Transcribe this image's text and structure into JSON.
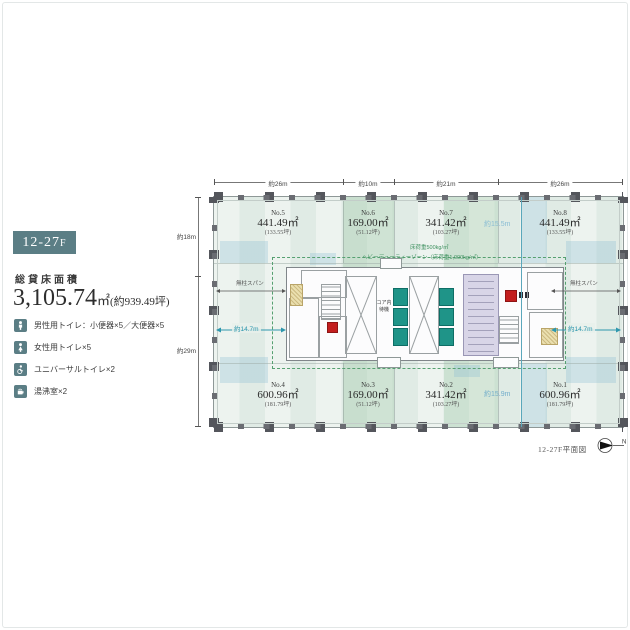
{
  "page": {
    "caption": "12-27F平面図",
    "north_label": "N"
  },
  "legend": {
    "floor_badge": "12-27",
    "floor_badge_suffix": "F",
    "area_label": "総貸床面積",
    "area_value": "3,105.74",
    "area_unit": "㎡",
    "area_tsubo": "(約939.49坪)",
    "facilities": [
      {
        "icon": "male-restroom-icon",
        "label": "男性用トイレ：小便器×5／大便器×5"
      },
      {
        "icon": "female-restroom-icon",
        "label": "女性用トイレ×5"
      },
      {
        "icon": "universal-restroom-icon",
        "label": "ユニバーサルトイレ×2"
      },
      {
        "icon": "kitchenette-icon",
        "label": "湯沸室×2"
      }
    ]
  },
  "plan": {
    "dims_top": [
      "約26m",
      "約10m",
      "約21m",
      "約26m"
    ],
    "dims_left": [
      "約18m",
      "約29m"
    ],
    "depth_top": "約15.5m",
    "depth_bottom": "約15.9m",
    "depth_left": "約14.7m",
    "depth_right": "約14.7m",
    "span_note_left": "無柱スパン",
    "span_note_right": "無柱スパン",
    "load_note_1": "床荷重500kg/㎡",
    "load_note_2": "ヘビーデューティーゾーン（床荷重1,000kg/㎡）",
    "core_label_line1": "コア内",
    "core_label_line2": "待機",
    "rooms_top": [
      {
        "no": "No.5",
        "area": "441.49㎡",
        "tsubo": "(133.55坪)"
      },
      {
        "no": "No.6",
        "area": "169.00㎡",
        "tsubo": "(51.12坪)"
      },
      {
        "no": "No.7",
        "area": "341.42㎡",
        "tsubo": "(103.27坪)"
      },
      {
        "no": "No.8",
        "area": "441.49㎡",
        "tsubo": "(133.55坪)"
      }
    ],
    "rooms_bottom": [
      {
        "no": "No.4",
        "area": "600.96㎡",
        "tsubo": "(181.79坪)"
      },
      {
        "no": "No.3",
        "area": "169.00㎡",
        "tsubo": "(51.12坪)"
      },
      {
        "no": "No.2",
        "area": "341.42㎡",
        "tsubo": "(103.27坪)"
      },
      {
        "no": "No.1",
        "area": "600.96㎡",
        "tsubo": "(181.79坪)"
      }
    ]
  },
  "colors": {
    "badge": "#5b7e85",
    "lease_bg": "#e8f0eb",
    "green_zone": "#a8ccad",
    "blue_zone": "#8cbed4",
    "elevator_teal": "#1f9488",
    "toilet_lavender": "#d8d5e7",
    "alarm_red": "#c31e1e",
    "note_green": "#3f9160",
    "dim_blue": "#74aecb",
    "dim_teal": "#2e97ad",
    "column_gray": "#54565c"
  }
}
